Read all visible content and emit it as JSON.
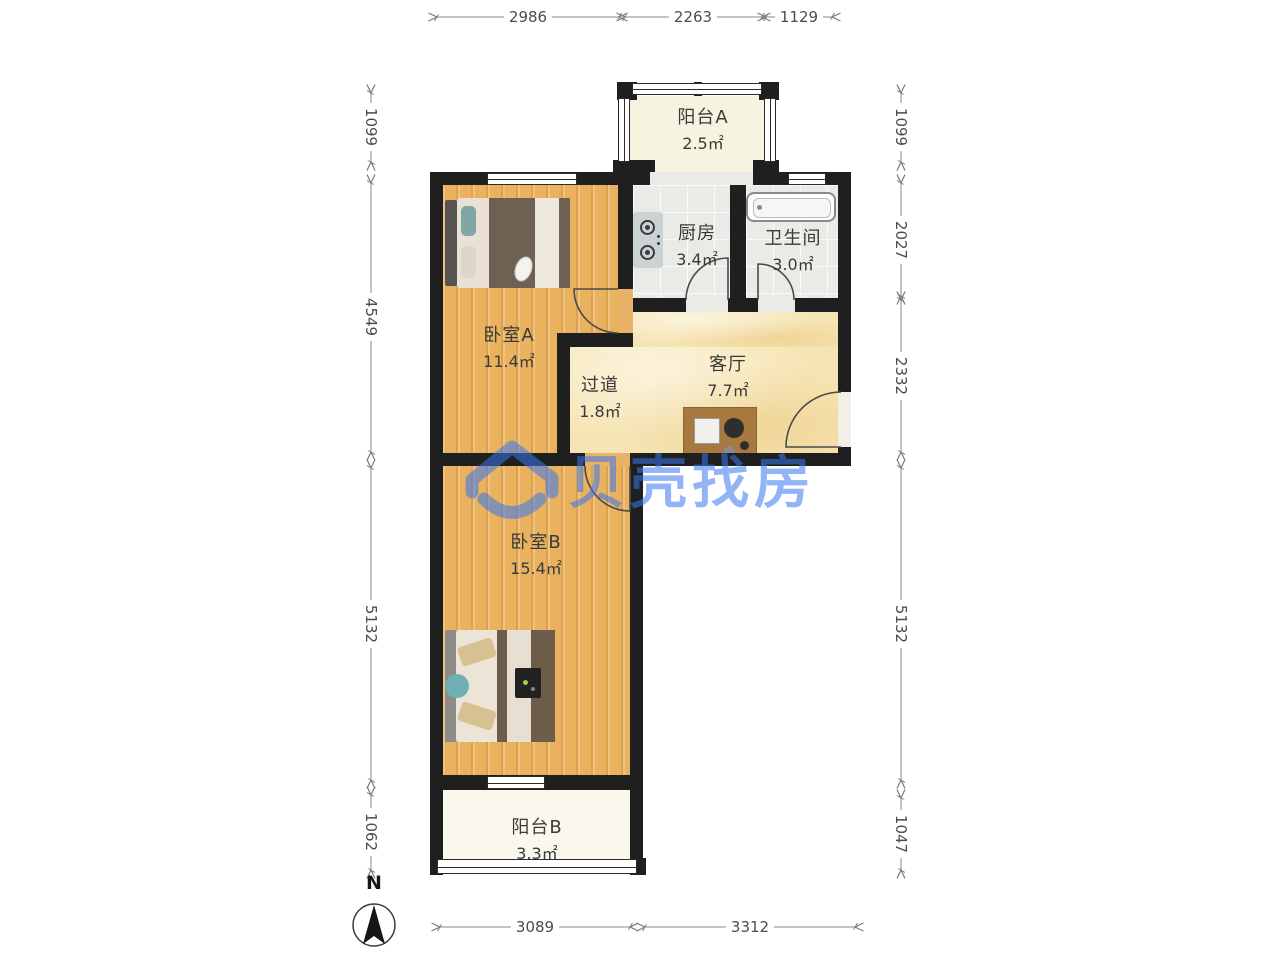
{
  "brand": {
    "name": "贝壳找房",
    "logo_icon": "beike-shell-house-smile",
    "color": "#3877F0"
  },
  "compass": {
    "label": "N",
    "icon": "north-arrow"
  },
  "rooms": {
    "balcony_a": {
      "name": "阳台A",
      "area": "2.5㎡"
    },
    "kitchen": {
      "name": "厨房",
      "area": "3.4㎡"
    },
    "bathroom": {
      "name": "卫生间",
      "area": "3.0㎡"
    },
    "bedroom_a": {
      "name": "卧室A",
      "area": "11.4㎡"
    },
    "hallway": {
      "name": "过道",
      "area": "1.8㎡"
    },
    "living": {
      "name": "客厅",
      "area": "7.7㎡"
    },
    "bedroom_b": {
      "name": "卧室B",
      "area": "15.4㎡"
    },
    "balcony_b": {
      "name": "阳台B",
      "area": "3.3㎡"
    }
  },
  "dimensions_mm": {
    "top": [
      "2986",
      "2263",
      "1129"
    ],
    "left": [
      "1099",
      "4549",
      "5132",
      "1062"
    ],
    "right": [
      "1099",
      "2027",
      "2332",
      "5132",
      "1047"
    ],
    "bottom": [
      "3089",
      "3312"
    ]
  },
  "colors": {
    "wall": "#1f1f1f",
    "wood_floor": "#eab25e",
    "marble_floor": "#f6e5b4",
    "tile_floor": "#eaeae7",
    "balcony_floor": "#f7f3e1",
    "watermark_blue": "#3877F0"
  }
}
